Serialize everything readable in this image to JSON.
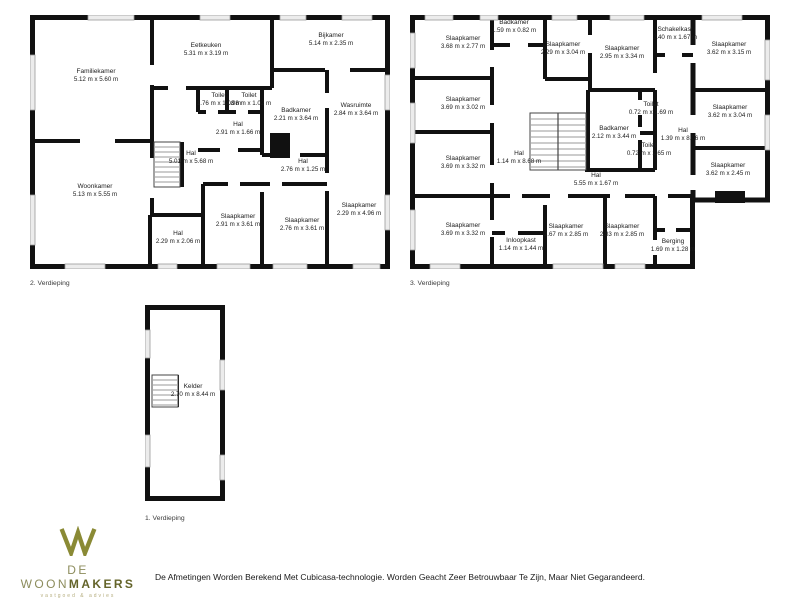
{
  "page": {
    "background": "#ffffff",
    "wall_color": "#111111",
    "window_fill": "#ececec"
  },
  "plans": [
    {
      "label": "2. Verdieping",
      "rooms": [
        {
          "name": "Familiekamer",
          "dims": "5.12 m x 5.60 m"
        },
        {
          "name": "Eetkeuken",
          "dims": "5.31 m x 3.19 m"
        },
        {
          "name": "Bijkamer",
          "dims": "5.14 m x 2.35 m"
        },
        {
          "name": "Toilet",
          "dims": "1.76 m x 1.08 m"
        },
        {
          "name": "Toilet",
          "dims": "1.98 m x 1.02 m"
        },
        {
          "name": "Badkamer",
          "dims": "2.21 m x 3.64 m"
        },
        {
          "name": "Wasruimte",
          "dims": "2.84 m x 3.64 m"
        },
        {
          "name": "Hal",
          "dims": "2.91 m x 1.66 m"
        },
        {
          "name": "Hal",
          "dims": "5.01 m x 5.68 m"
        },
        {
          "name": "Hal",
          "dims": "2.76 m x 1.25 m"
        },
        {
          "name": "Woonkamer",
          "dims": "5.13 m x 5.55 m"
        },
        {
          "name": "Slaapkamer",
          "dims": "2.91 m x 3.61 m"
        },
        {
          "name": "Slaapkamer",
          "dims": "2.76 m x 3.61 m"
        },
        {
          "name": "Slaapkamer",
          "dims": "2.29 m x 4.96 m"
        },
        {
          "name": "Hal",
          "dims": "2.29 m x 2.06 m"
        }
      ]
    },
    {
      "label": "3. Verdieping",
      "rooms": [
        {
          "name": "Slaapkamer",
          "dims": "3.68 m x 2.77 m"
        },
        {
          "name": "Badkamer",
          "dims": "1.59 m x 0.82 m"
        },
        {
          "name": "Slaapkamer",
          "dims": "2.29 m x 3.04 m"
        },
        {
          "name": "Slaapkamer",
          "dims": "2.95 m x 3.34 m"
        },
        {
          "name": "Schakelkast",
          "dims": "2.40 m x 1.67 m"
        },
        {
          "name": "Slaapkamer",
          "dims": "3.62 m x 3.15 m"
        },
        {
          "name": "Slaapkamer",
          "dims": "3.69 m x 3.02 m"
        },
        {
          "name": "Slaapkamer",
          "dims": "3.69 m x 3.32 m"
        },
        {
          "name": "Slaapkamer",
          "dims": "3.69 m x 3.32 m"
        },
        {
          "name": "Badkamer",
          "dims": "2.12 m x 3.44 m"
        },
        {
          "name": "Toilet",
          "dims": "0.72 m x 1.69 m"
        },
        {
          "name": "Toilet",
          "dims": "0.72 m x 1.65 m"
        },
        {
          "name": "Hal",
          "dims": "1.14 m x 8.68 m"
        },
        {
          "name": "Hal",
          "dims": "1.39 m x 8.06 m"
        },
        {
          "name": "Hal",
          "dims": "5.55 m x 1.67 m"
        },
        {
          "name": "Slaapkamer",
          "dims": "3.62 m x 3.04 m"
        },
        {
          "name": "Slaapkamer",
          "dims": "3.62 m x 2.45 m"
        },
        {
          "name": "Inloopkast",
          "dims": "1.14 m x 1.44 m"
        },
        {
          "name": "Slaapkamer",
          "dims": "2.67 m x 2.85 m"
        },
        {
          "name": "Slaapkamer",
          "dims": "2.83 m x 2.85 m"
        },
        {
          "name": "Berging",
          "dims": "1.69 m x 1.28 m"
        }
      ]
    },
    {
      "label": "1. Verdieping",
      "rooms": [
        {
          "name": "Kelder",
          "dims": "2.70 m x 8.44 m"
        }
      ]
    }
  ],
  "brand": {
    "name_prefix": "DE WOON",
    "name_suffix": "MAKERS",
    "tagline": "vastgoed & advies",
    "colors": {
      "logo": "#8a8a35",
      "name": "#8c8c5c",
      "name_bold": "#64642a",
      "tagline": "#b5ad7e"
    }
  },
  "disclaimer": "De Afmetingen Worden Berekend Met Cubicasa-technologie. Worden Geacht Zeer Betrouwbaar Te Zijn, Maar Niet Gegarandeerd."
}
